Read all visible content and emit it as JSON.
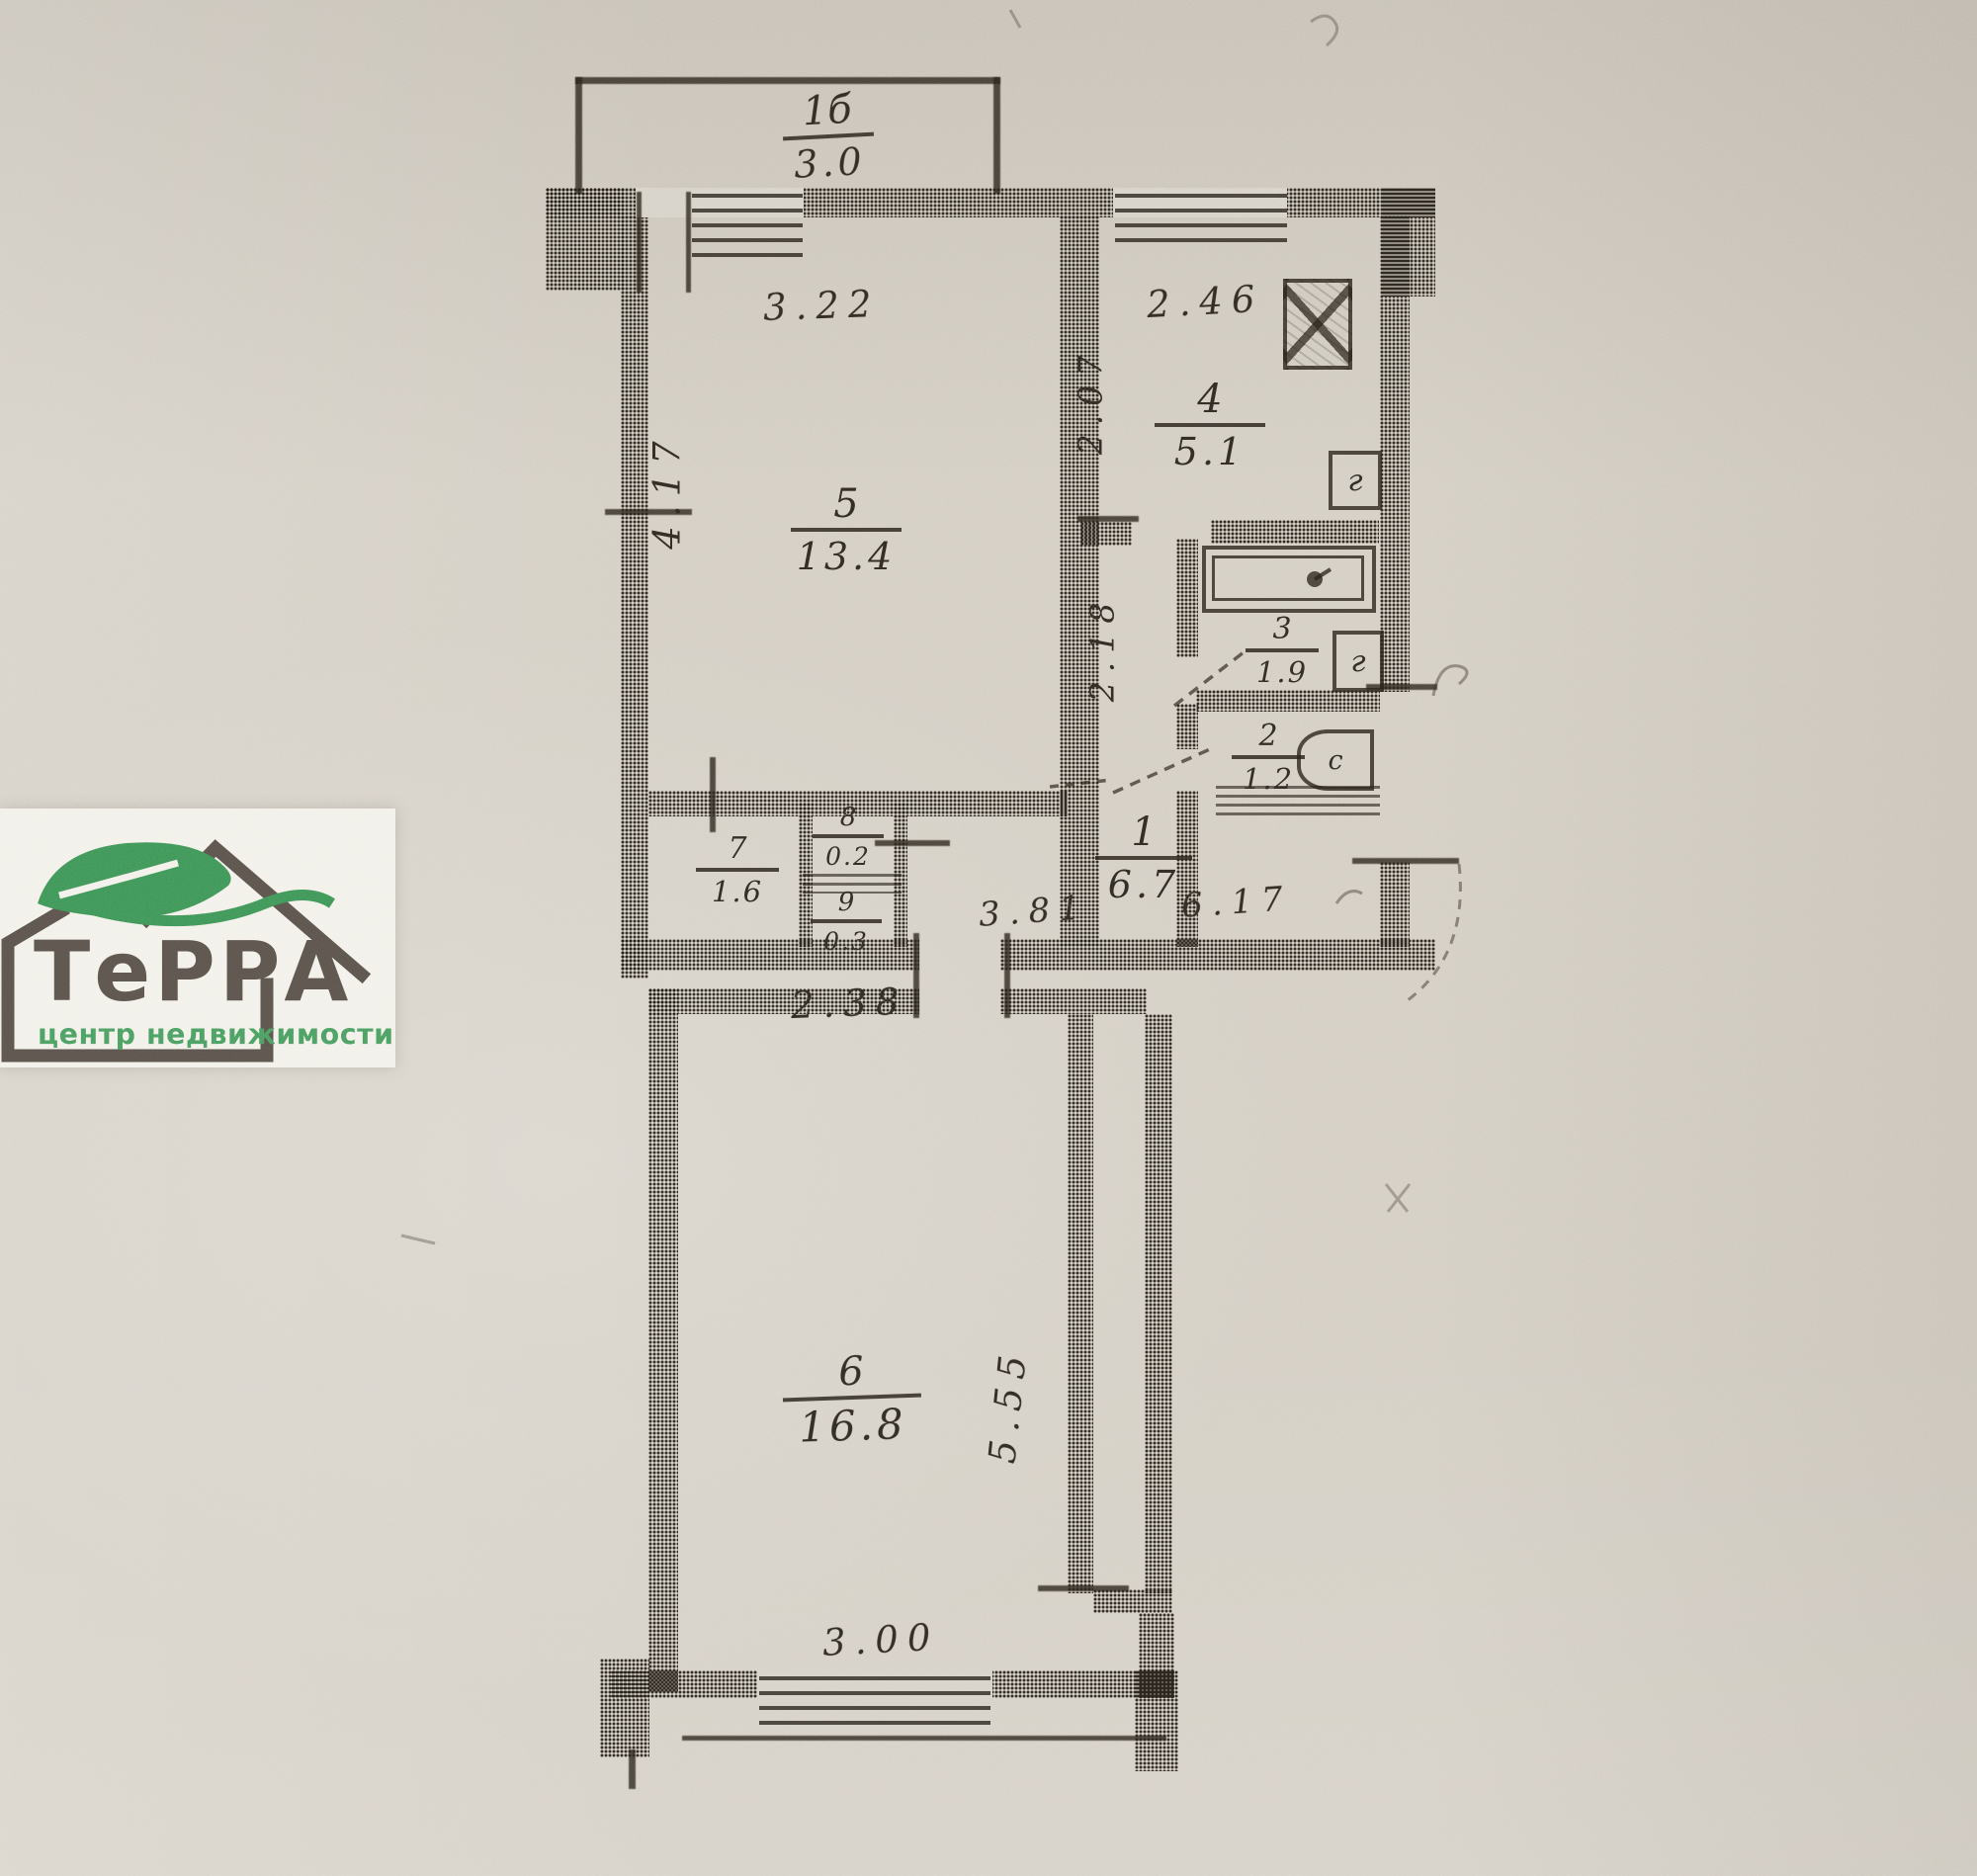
{
  "document_type": "apartment floor plan scan",
  "colors": {
    "paper": "#d2ccc2",
    "ink": "#2e2a23",
    "logo_brown": "#57504a",
    "logo_green": "#3d8f55",
    "logo_text_green": "#48995e",
    "logo_card": "#f2f0e9"
  },
  "logo": {
    "brand": "ТеРРА",
    "tagline": "центр недвижимости"
  },
  "plan": {
    "balcony": {
      "number": "1б",
      "area": "3.0"
    },
    "rooms": [
      {
        "number": "5",
        "area": "13.4"
      },
      {
        "number": "4",
        "area": "5.1"
      },
      {
        "number": "3",
        "area": "1.9"
      },
      {
        "number": "2",
        "area": "1.2"
      },
      {
        "number": "1",
        "area": "6.7"
      },
      {
        "number": "7",
        "area": "1.6"
      },
      {
        "number": "8",
        "area": "0.2"
      },
      {
        "number": "9",
        "area": "0.3"
      },
      {
        "number": "6",
        "area": "16.8"
      }
    ],
    "dimensions": {
      "room5_width": "3.22",
      "kitchen_width": "2.46",
      "room5_depth": "4.17",
      "kitchen_depth": "2.07",
      "hall_depth": "2.18",
      "hall_door_span": "3.81",
      "hall_total_width": "6.17",
      "corridor_width": "2.38",
      "room6_depth": "5.55",
      "room6_width": "3.00"
    },
    "fixtures": {
      "bath_sink_mark": "г",
      "kitchen_mark": "г",
      "toilet_mark": "с"
    }
  }
}
